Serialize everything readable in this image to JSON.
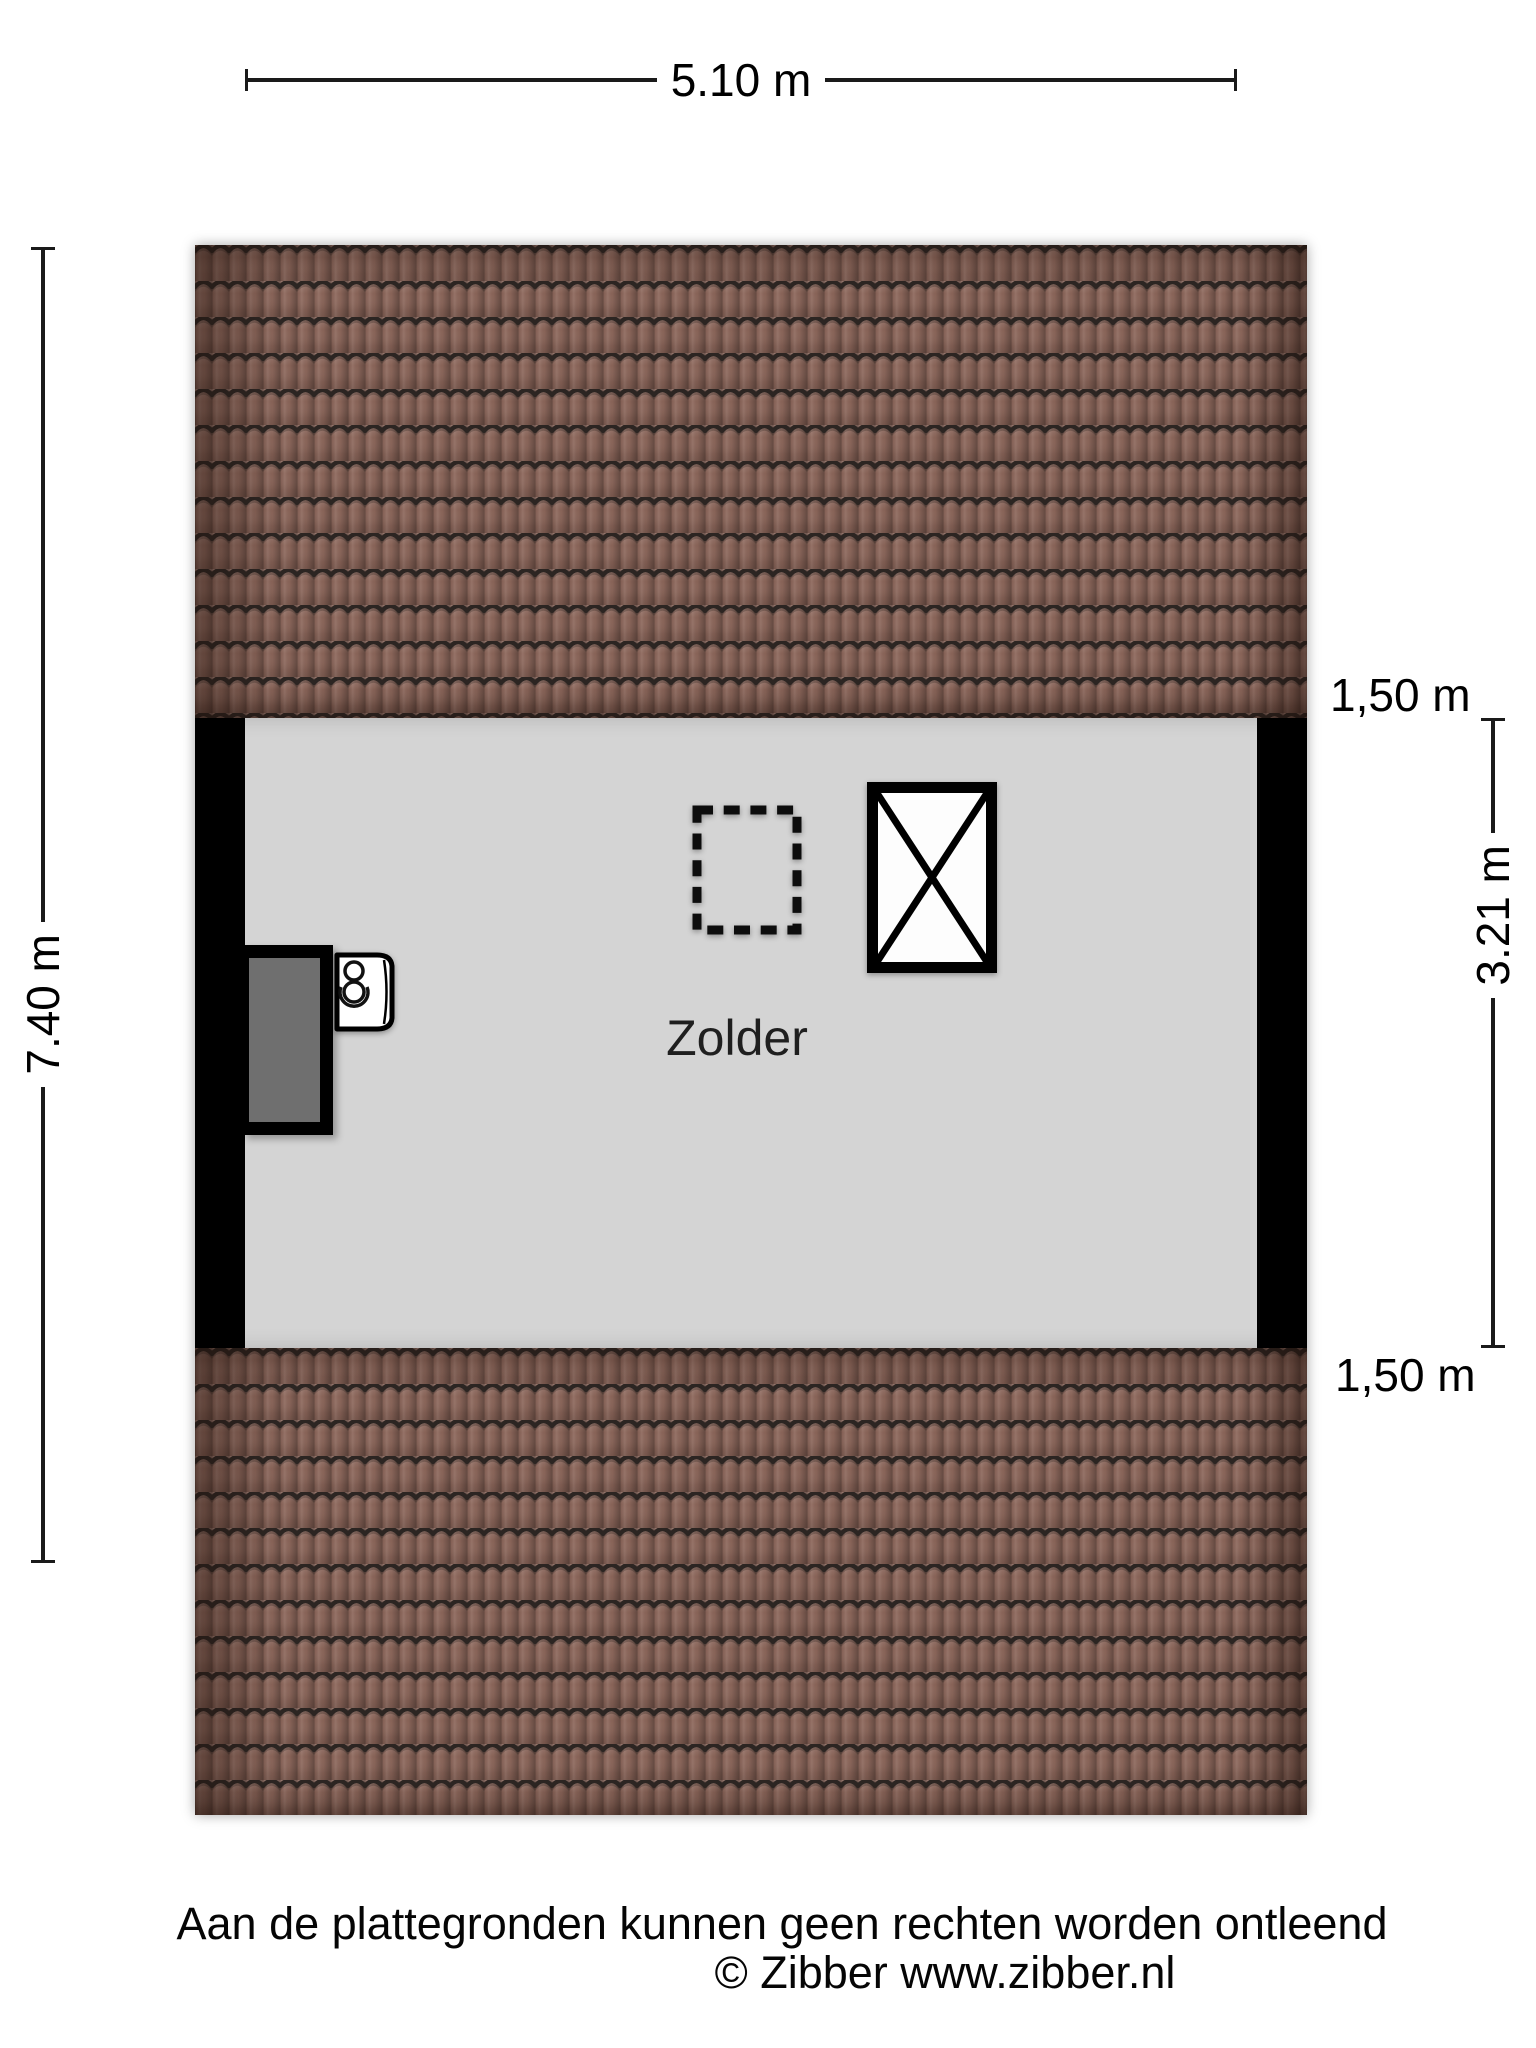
{
  "dimensions": {
    "top": "5.10 m",
    "left": "7.40 m",
    "right_top": "1,50 m",
    "right_middle": "3.21 m",
    "right_bottom": "1,50 m"
  },
  "room": {
    "label": "Zolder"
  },
  "footer": {
    "line1": "Aan de plattegronden kunnen geen rechten worden ontleend",
    "line2": "© Zibber www.zibber.nl"
  },
  "colors": {
    "background": "#ffffff",
    "floor": "#d4d4d4",
    "wall": "#000000",
    "roof_tile": "#8c665a",
    "roof_joint_line": "#2c2522",
    "closet_fill": "#6f6f6f",
    "symbol_fill": "#ffffff"
  }
}
